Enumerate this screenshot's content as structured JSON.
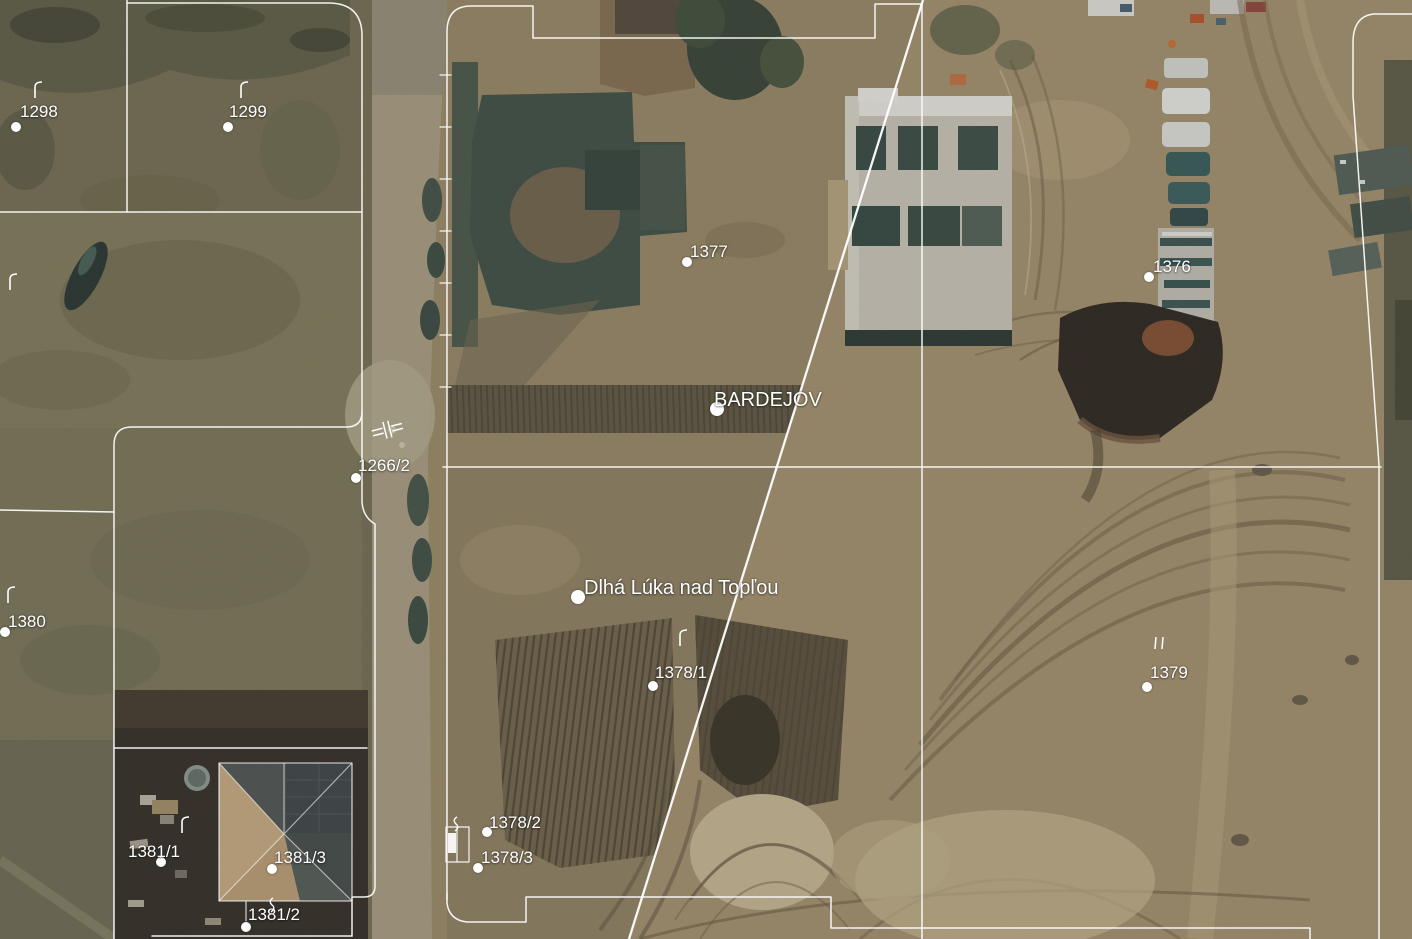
{
  "map": {
    "type": "cadastral-orthophoto",
    "colors": {
      "boundary": "#ffffff",
      "label": "#ffffff",
      "seam": "#ffffff"
    },
    "municipalities": [
      {
        "name": "BARDEJOV",
        "x": 714,
        "y": 390,
        "dot_x": 717,
        "dot_y": 409,
        "dot_r": 7
      },
      {
        "name": "Dlhá Lúka nad Topľou",
        "x": 584,
        "y": 578,
        "dot_x": 578,
        "dot_y": 597,
        "dot_r": 7
      }
    ],
    "parcels": [
      {
        "label": "1298",
        "tx": 20,
        "ty": 103,
        "dx": 16,
        "dy": 127
      },
      {
        "label": "1299",
        "tx": 229,
        "ty": 103,
        "dx": 228,
        "dy": 127
      },
      {
        "label": "1377",
        "tx": 690,
        "ty": 243,
        "dx": 687,
        "dy": 262
      },
      {
        "label": "1376",
        "tx": 1153,
        "ty": 258,
        "dx": 1149,
        "dy": 277
      },
      {
        "label": "1266/2",
        "tx": 358,
        "ty": 457,
        "dx": 356,
        "dy": 478
      },
      {
        "label": "1380",
        "tx": 8,
        "ty": 613,
        "dx": 5,
        "dy": 632
      },
      {
        "label": "1378/1",
        "tx": 655,
        "ty": 664,
        "dx": 653,
        "dy": 686
      },
      {
        "label": "1379",
        "tx": 1150,
        "ty": 664,
        "dx": 1147,
        "dy": 687
      },
      {
        "label": "1378/2",
        "tx": 489,
        "ty": 814,
        "dx": 487,
        "dy": 832
      },
      {
        "label": "1378/3",
        "tx": 481,
        "ty": 849,
        "dx": 478,
        "dy": 868
      },
      {
        "label": "1381/1",
        "tx": 128,
        "ty": 843,
        "dx": 161,
        "dy": 862
      },
      {
        "label": "1381/3",
        "tx": 274,
        "ty": 849,
        "dx": 272,
        "dy": 869
      },
      {
        "label": "1381/2",
        "tx": 248,
        "ty": 906,
        "dx": 246,
        "dy": 927
      }
    ],
    "symbols": [
      {
        "glyph": "grass",
        "x": 33,
        "y": 80
      },
      {
        "glyph": "grass",
        "x": 239,
        "y": 80
      },
      {
        "glyph": "grass",
        "x": 8,
        "y": 272
      },
      {
        "glyph": "grass",
        "x": 6,
        "y": 585
      },
      {
        "glyph": "grass",
        "x": 180,
        "y": 815
      },
      {
        "glyph": "grass",
        "x": 678,
        "y": 628
      },
      {
        "glyph": "double-bar",
        "x": 1152,
        "y": 636
      },
      {
        "glyph": "road-crossing",
        "x": 370,
        "y": 418
      },
      {
        "glyph": "hook",
        "x": 266,
        "y": 897
      },
      {
        "glyph": "hook",
        "x": 450,
        "y": 816
      }
    ]
  }
}
